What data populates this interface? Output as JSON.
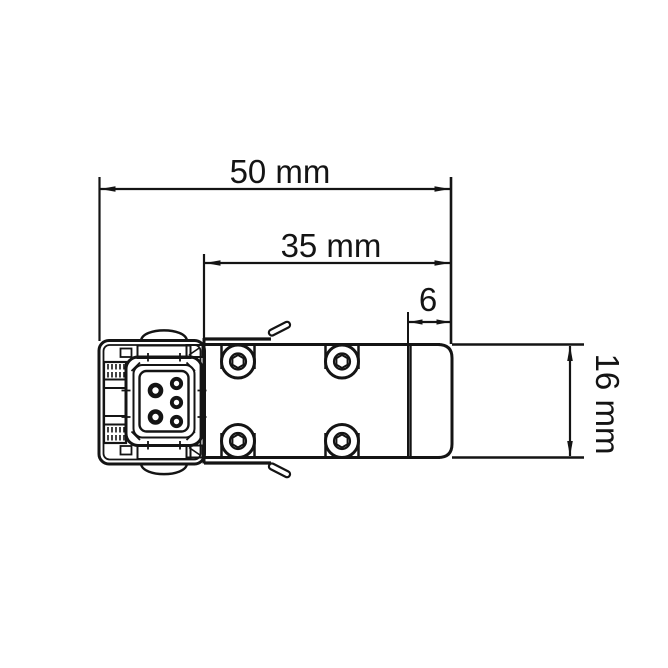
{
  "drawing": {
    "kind": "technical-dimension-drawing",
    "stroke_color": "#141414",
    "background_color": "#ffffff",
    "dimensions": {
      "overall_width": {
        "label": "50 mm",
        "value": 50,
        "unit": "mm",
        "orientation": "horizontal"
      },
      "body_width": {
        "label": "35 mm",
        "value": 35,
        "unit": "mm",
        "orientation": "horizontal"
      },
      "end_cap_width": {
        "label": "6",
        "value": 6,
        "unit": "mm",
        "orientation": "horizontal"
      },
      "body_height": {
        "label": "16 mm",
        "value": 16,
        "unit": "mm",
        "orientation": "vertical"
      }
    },
    "device": {
      "connector_pin_count": 5,
      "mounting_screw_count": 4
    }
  }
}
